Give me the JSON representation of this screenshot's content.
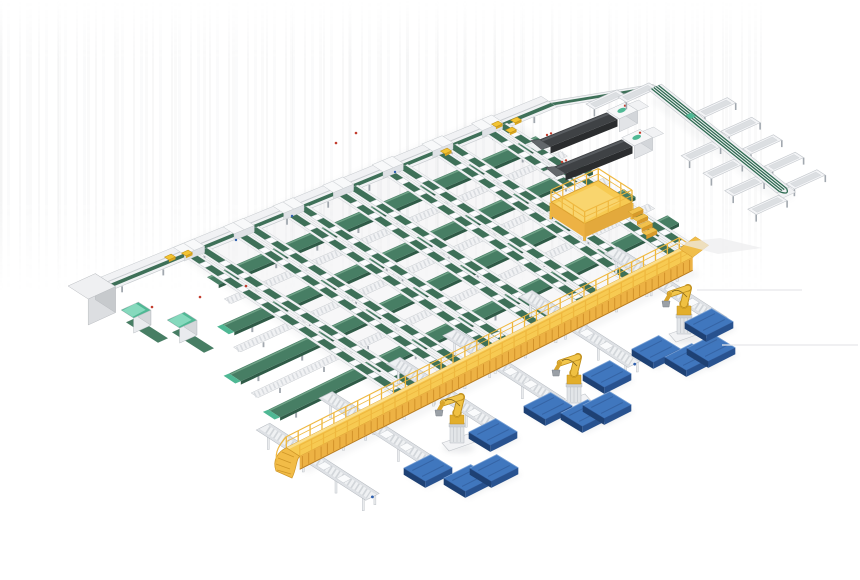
{
  "meta": {
    "description": "3D isometric render of an automated warehouse sorting and palletizing system",
    "background": "#FFFFFF"
  },
  "palette": {
    "green_belt": "#477E64",
    "green_dark": "#2F5B47",
    "green_light": "#74A68B",
    "lane_belt": "#3E7058",
    "frame_white": "#F1F2F4",
    "frame_stroke": "#C5C9CD",
    "frame_shade": "#DFE2E6",
    "leg_gray": "#A2A8AF",
    "deck_yellow": "#F7CA52",
    "deck_highlight": "#FBDF8C",
    "rib_yellow": "#EDB244",
    "rib_shadow": "#D2922A",
    "rail_yellow": "#EFB83F",
    "deep_orange": "#B87C20",
    "robot_yellow": "#EFBE38",
    "robot_dark": "#C08F1C",
    "robot_gray": "#9AA0A6",
    "pallet_top": "#4077BE",
    "pallet_front": "#28528F",
    "pallet_side": "#1E4174",
    "pallet_rim": "#7FA8DC",
    "pallet_slat": "#33609F",
    "machine_dark": "#3F4245",
    "machine_darker": "#2A2C2E",
    "machine_light": "#63676B",
    "mint": "#4FB894",
    "mint_light": "#8FDEC4",
    "cabinet_top": "#EFF0F2",
    "cabinet_front": "#DCDEE1",
    "cabinet_side": "#C7CACD",
    "parcel_yellow": "#F3C433",
    "parcel_stroke": "#C2931B",
    "parcel_lip": "#D9A621",
    "tray_inner": "#DCDFE2",
    "red_dot": "#C23D2E",
    "blue_dot": "#2E5FAE",
    "shadow": "#707680",
    "artifact": "#E7E8EA"
  },
  "array": {
    "head_a": [
      197,
      252
    ],
    "head_b": [
      495,
      128
    ],
    "foot_a": [
      410,
      391
    ],
    "foot_b": [
      684,
      253
    ],
    "lanes": 7,
    "cross_belts": [
      {
        "f": 0.155,
        "i0": -0.35,
        "i1": 6.35,
        "cap": false
      },
      {
        "f": 0.385,
        "i0": -1.05,
        "i1": 6.4,
        "cap": true
      },
      {
        "f": 0.6,
        "i0": -1.9,
        "i1": 6.45,
        "cap": true
      },
      {
        "f": 0.82,
        "i0": -2.1,
        "i1": 6.5,
        "cap": true
      }
    ],
    "roller_lines": [
      {
        "f": 0.27,
        "i0": -0.55,
        "i1": 6.37
      },
      {
        "f": 0.49,
        "i0": -1.35,
        "i1": 6.42
      },
      {
        "f": 0.71,
        "i0": -2.0,
        "i1": 6.47
      }
    ]
  },
  "infeed": {
    "from": [
      95,
      292
    ],
    "to": [
      553,
      104
    ],
    "connector_to": [
      657,
      87
    ]
  },
  "parcels": [
    [
      170,
      257
    ],
    [
      187,
      253
    ],
    [
      446,
      151
    ],
    [
      497,
      124
    ],
    [
      511,
      130
    ],
    [
      516,
      120
    ]
  ],
  "red_dots": [
    [
      152,
      307
    ],
    [
      200,
      297
    ],
    [
      246,
      286
    ],
    [
      336,
      143
    ],
    [
      356,
      133
    ]
  ],
  "blue_dots": [
    [
      236,
      240
    ],
    [
      292,
      216
    ],
    [
      395,
      172
    ],
    [
      552,
      218
    ],
    [
      608,
      190
    ],
    [
      700,
      128
    ]
  ],
  "cabinet": {
    "o": [
      68,
      286
    ],
    "w": 30,
    "d": 24,
    "h": 26
  },
  "teal_cabinets": [
    {
      "o": [
        121,
        310
      ],
      "w": 19,
      "d": 15,
      "h": 15
    },
    {
      "o": [
        167,
        320
      ],
      "w": 19,
      "d": 15,
      "h": 15
    }
  ],
  "machines": [
    {
      "a": [
        545,
        143
      ],
      "b": [
        612,
        116
      ]
    },
    {
      "a": [
        560,
        170
      ],
      "b": [
        627,
        143
      ]
    }
  ],
  "platform": {
    "o": [
      551,
      202
    ],
    "u": 52,
    "v": 40,
    "leg_h": 16,
    "rail_h": 12,
    "steps": 4
  },
  "spine": {
    "a": [
      655,
      87
    ],
    "b": [
      783,
      190
    ],
    "chutes_sw": [
      0.5,
      0.67,
      0.84,
      1.02
    ],
    "chutes_ne": [
      0.27,
      0.46,
      0.63,
      0.8,
      0.97
    ],
    "chute_len": 34,
    "top_trays": [
      [
        586,
        104
      ],
      [
        618,
        97
      ]
    ]
  },
  "walkway": {
    "from": [
      293,
      452
    ],
    "to": [
      686,
      253
    ],
    "half": 8,
    "face_h": 13,
    "rail_h": 11
  },
  "output_lanes": {
    "t": [
      6,
      76,
      152,
      215,
      300,
      396
    ],
    "back": 42,
    "fwd": 88,
    "half": 7.5
  },
  "robots": [
    [
      457,
      440
    ],
    [
      574,
      400
    ],
    [
      684,
      331
    ]
  ],
  "pallets": [
    [
      428,
      468
    ],
    [
      468,
      478
    ],
    [
      494,
      468
    ],
    [
      493,
      432
    ],
    [
      548,
      406
    ],
    [
      585,
      413
    ],
    [
      607,
      405
    ],
    [
      607,
      374
    ],
    [
      656,
      349
    ],
    [
      689,
      357
    ],
    [
      711,
      348
    ],
    [
      709,
      322
    ]
  ],
  "artifact_lines": [
    [
      697,
      290,
      802,
      290
    ],
    [
      722,
      345,
      858,
      345
    ]
  ],
  "artifact_blob": [
    [
      676,
      243
    ],
    [
      720,
      238
    ],
    [
      762,
      248
    ],
    [
      718,
      254
    ]
  ]
}
